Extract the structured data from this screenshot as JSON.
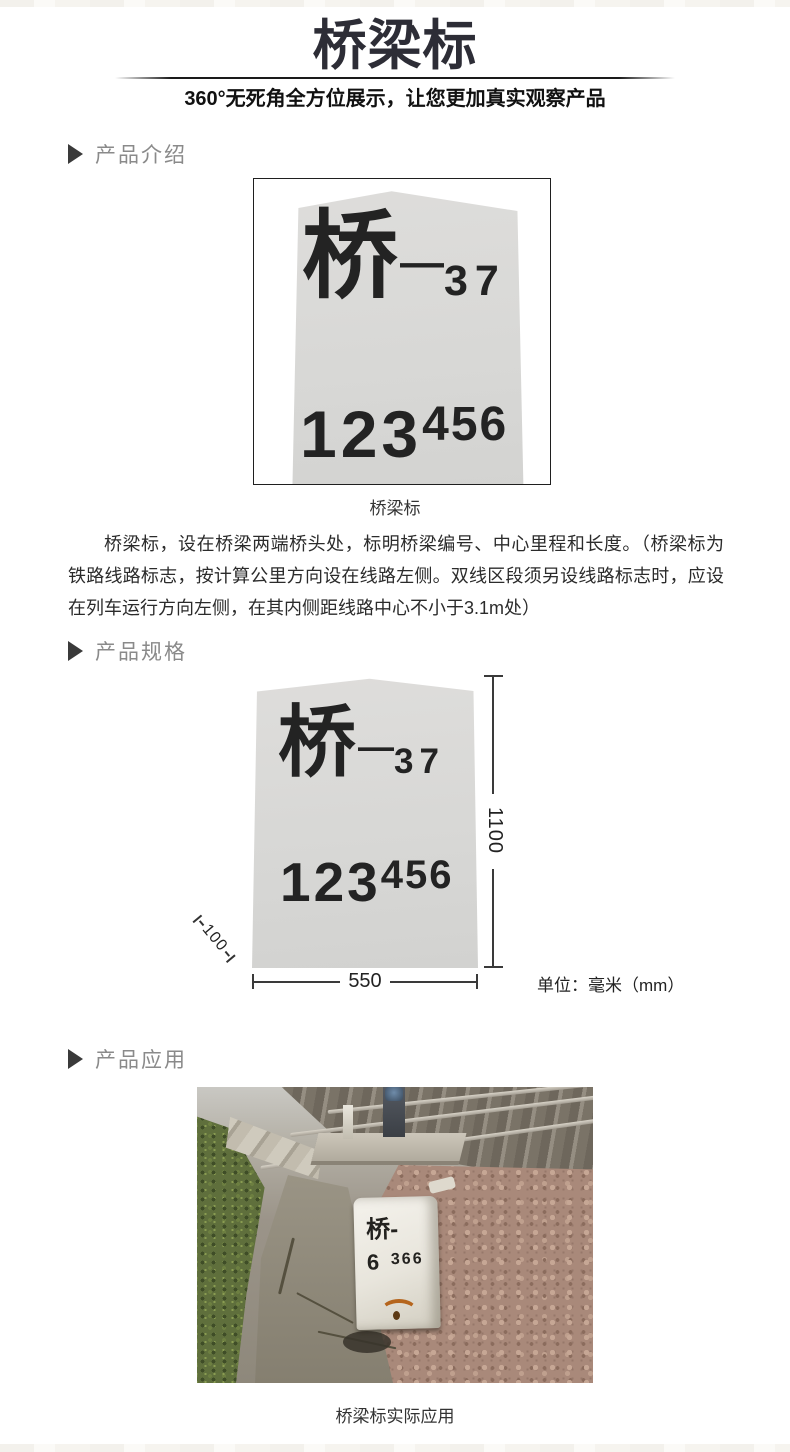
{
  "header": {
    "title": "桥梁标",
    "subtitle": "360°无死角全方位展示，让您更加真实观察产品"
  },
  "sections": {
    "intro_label": "产品介绍",
    "spec_label": "产品规格",
    "app_label": "产品应用"
  },
  "marker": {
    "char": "桥",
    "dash": "—",
    "bridge_no": "37",
    "mileage_main": "123",
    "mileage_sup": "456"
  },
  "intro": {
    "caption": "桥梁标",
    "description": "桥梁标，设在桥梁两端桥头处，标明桥梁编号、中心里程和长度。（桥梁标为铁路线路标志，按计算公里方向设在线路左侧。双线区段须另设线路标志时，应设在列车运行方向左侧，在其内侧距线路中心不小于3.1m处）"
  },
  "spec": {
    "height_mm": "1100",
    "width_mm": "550",
    "depth_mm": "100",
    "unit": "单位：毫米（mm）"
  },
  "app": {
    "caption": "桥梁标实际应用",
    "stone_char": "桥-",
    "stone_km": "6",
    "stone_m": "366"
  },
  "colors": {
    "title": "#2d2d36",
    "section_label": "#8a8a8a",
    "marker_fill": "#d9d9d7",
    "body_text": "#2b2b2b",
    "dim_line": "#3a3a3a",
    "gravel": "#a9897a",
    "vegetation": "#5f6f3c"
  }
}
